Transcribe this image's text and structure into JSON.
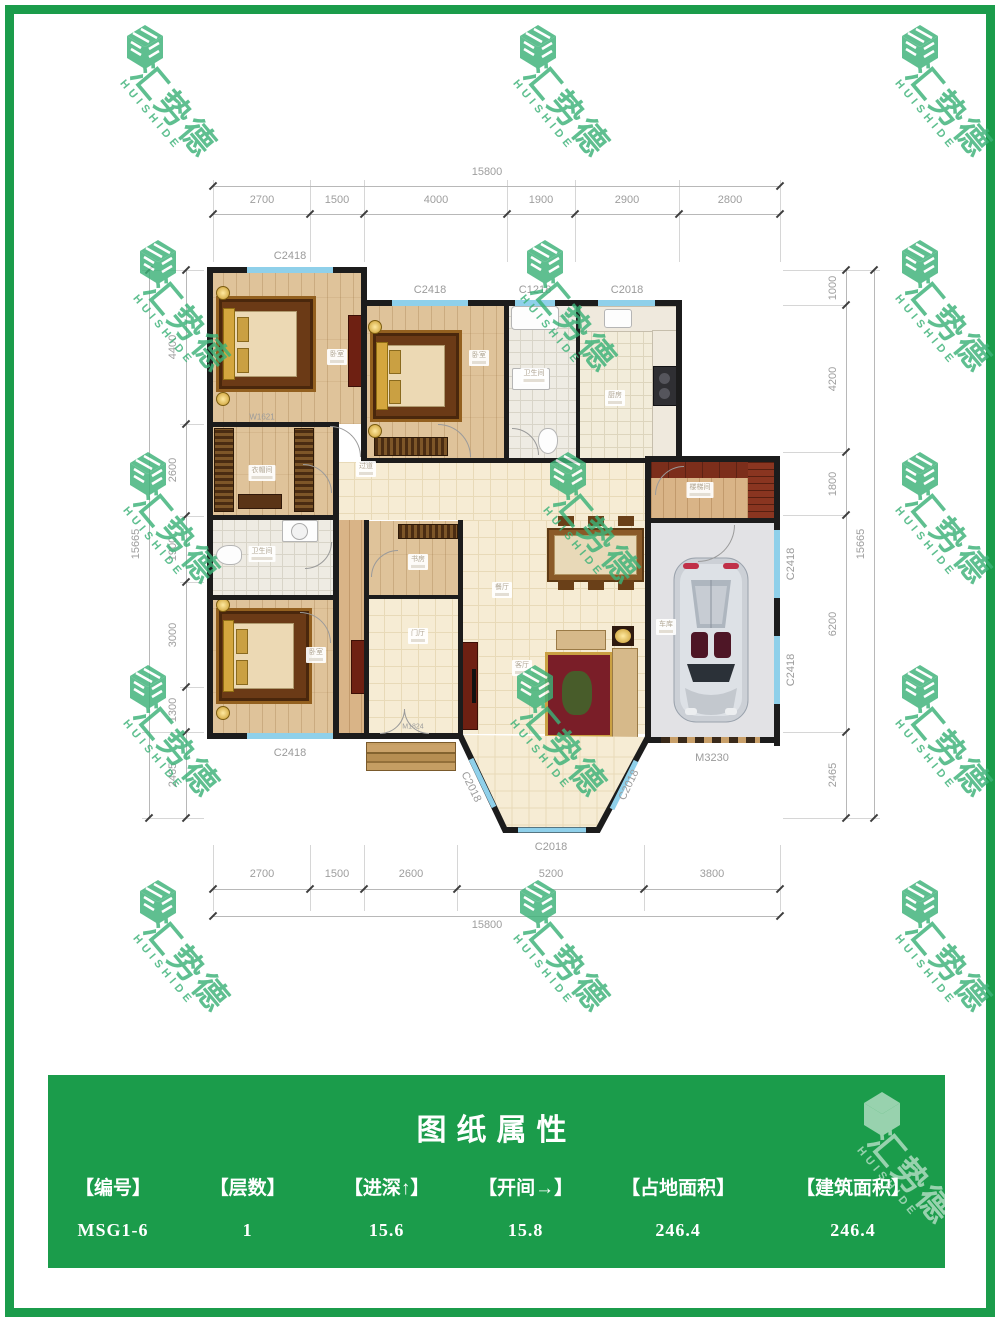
{
  "watermark": {
    "cn": "汇势德",
    "en": "HUISHIDE",
    "green": "#3cb278",
    "white": "#ffffff"
  },
  "colors": {
    "frame": "#1b9c4b",
    "banner": "#1b9c4b",
    "window": "#8fd0ea",
    "wall": "#1c1c1c"
  },
  "dims": {
    "top": {
      "total": "15800",
      "segs": [
        "2700",
        "1500",
        "4000",
        "1900",
        "2900",
        "2800"
      ]
    },
    "bottom": {
      "total": "15800",
      "segs": [
        "2700",
        "1500",
        "2600",
        "5200",
        "3800"
      ]
    },
    "left": {
      "total": "15665",
      "segs": [
        "4400",
        "2600",
        "1900",
        "3000",
        "1300",
        "2465"
      ]
    },
    "right": {
      "total": "15665",
      "segs": [
        "1000",
        "4200",
        "1800",
        "6200",
        "2465"
      ]
    }
  },
  "openings": {
    "bed1_top": "C2418",
    "bed2_top": "C2418",
    "bath_top": "C1218",
    "kitchen_top": "C2018",
    "bed3_bottom": "C2418",
    "bay_left": "C2018",
    "bay_bottom": "C2018",
    "bay_right": "C2018",
    "garage_right_upper": "C2418",
    "garage_right_lower": "C2418",
    "garage_door": "M3230",
    "cloak_window": "W1621",
    "entry_door": "M1824"
  },
  "rooms": {
    "bedroom1": "卧室",
    "bedroom2": "卧室",
    "bathroom1": "卫生间",
    "kitchen": "厨房",
    "cloakroom": "衣帽间",
    "hallway": "过道",
    "bathroom2": "卫生间",
    "bedroom3": "卧室",
    "study": "书房",
    "foyer": "门厅",
    "dining": "餐厅",
    "living": "客厅",
    "garage": "车库",
    "stairs": "楼梯间"
  },
  "title_block": {
    "title": "图纸属性",
    "columns": [
      {
        "header": "【编号】",
        "value": "MSG1-6"
      },
      {
        "header": "【层数】",
        "value": "1"
      },
      {
        "header": "【进深↑】",
        "value": "15.6"
      },
      {
        "header": "【开间→】",
        "value": "15.8"
      },
      {
        "header": "【占地面积】",
        "value": "246.4"
      },
      {
        "header": "【建筑面积】",
        "value": "246.4"
      }
    ]
  }
}
